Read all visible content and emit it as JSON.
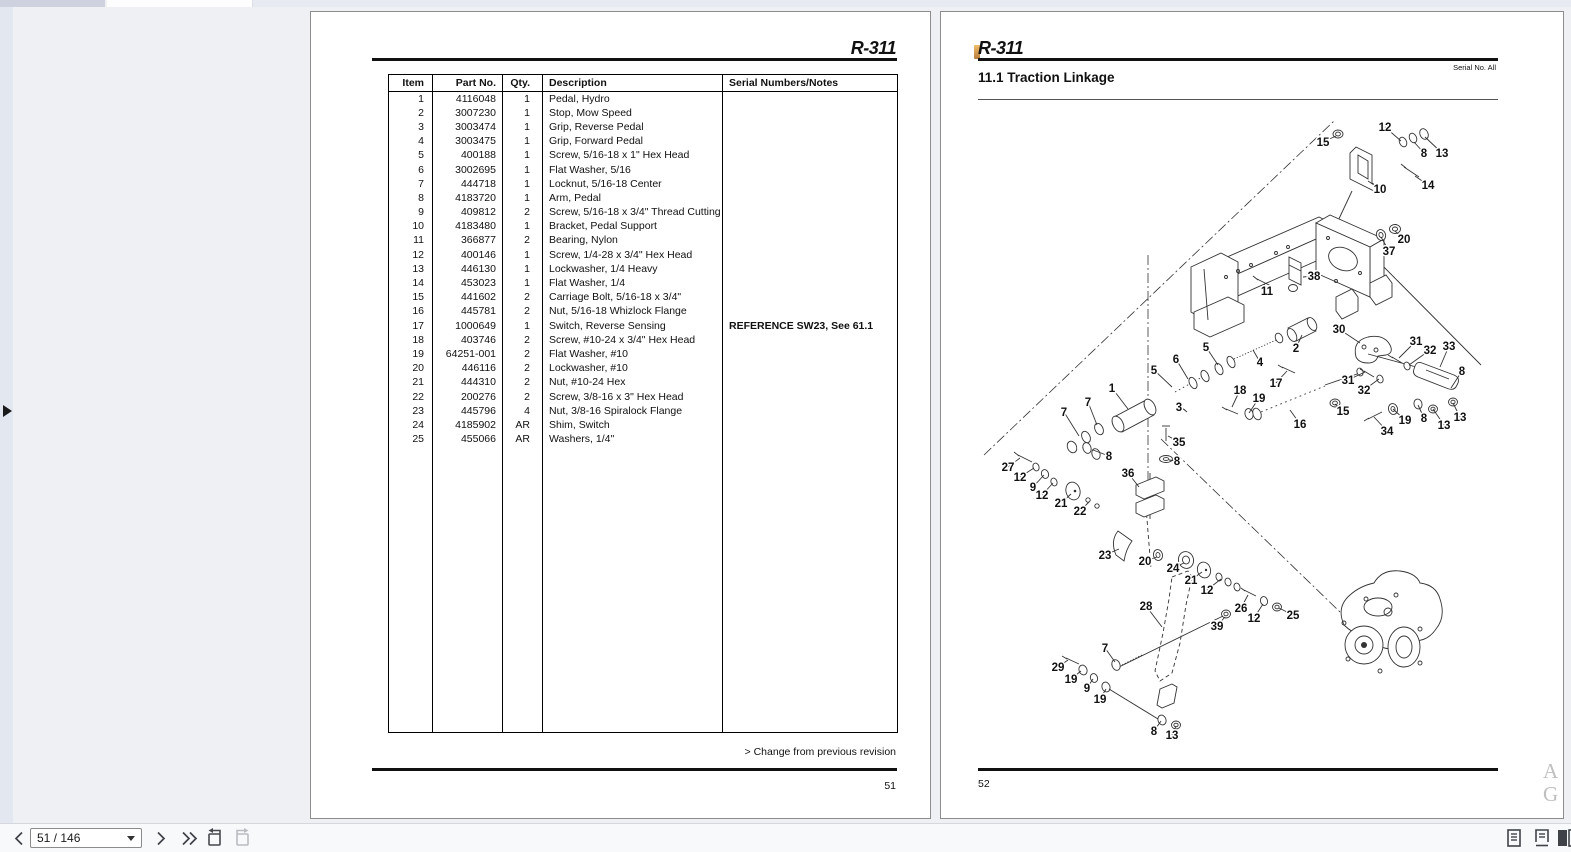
{
  "left_page": {
    "header_title": "R-311",
    "change_note": "> Change from previous revision",
    "page_number": "51",
    "table": {
      "columns": [
        "Item",
        "Part No.",
        "Qty.",
        "Description",
        "Serial Numbers/Notes"
      ],
      "rows": [
        {
          "item": "1",
          "part": "4116048",
          "qty": "1",
          "desc": "Pedal, Hydro",
          "notes": ""
        },
        {
          "item": "2",
          "part": "3007230",
          "qty": "1",
          "desc": "Stop, Mow Speed",
          "notes": ""
        },
        {
          "item": "3",
          "part": "3003474",
          "qty": "1",
          "desc": "Grip, Reverse Pedal",
          "notes": ""
        },
        {
          "item": "4",
          "part": "3003475",
          "qty": "1",
          "desc": "Grip, Forward Pedal",
          "notes": ""
        },
        {
          "item": "5",
          "part": "400188",
          "qty": "1",
          "desc": "Screw, 5/16-18 x 1\" Hex Head",
          "notes": ""
        },
        {
          "item": "6",
          "part": "3002695",
          "qty": "1",
          "desc": "Flat Washer, 5/16",
          "notes": ""
        },
        {
          "item": "7",
          "part": "444718",
          "qty": "1",
          "desc": "Locknut, 5/16-18 Center",
          "notes": ""
        },
        {
          "item": "8",
          "part": "4183720",
          "qty": "1",
          "desc": "Arm, Pedal",
          "notes": ""
        },
        {
          "item": "9",
          "part": "409812",
          "qty": "2",
          "desc": "Screw, 5/16-18 x 3/4\" Thread Cutting",
          "notes": ""
        },
        {
          "item": "10",
          "part": "4183480",
          "qty": "1",
          "desc": "Bracket, Pedal Support",
          "notes": ""
        },
        {
          "item": "11",
          "part": "366877",
          "qty": "2",
          "desc": "Bearing, Nylon",
          "notes": ""
        },
        {
          "item": "12",
          "part": "400146",
          "qty": "1",
          "desc": "Screw, 1/4-28 x 3/4\" Hex Head",
          "notes": ""
        },
        {
          "item": "13",
          "part": "446130",
          "qty": "1",
          "desc": "Lockwasher, 1/4 Heavy",
          "notes": ""
        },
        {
          "item": "14",
          "part": "453023",
          "qty": "1",
          "desc": "Flat Washer, 1/4",
          "notes": ""
        },
        {
          "item": "15",
          "part": "441602",
          "qty": "2",
          "desc": "Carriage Bolt, 5/16-18 x 3/4\"",
          "notes": ""
        },
        {
          "item": "16",
          "part": "445781",
          "qty": "2",
          "desc": "Nut, 5/16-18 Whizlock Flange",
          "notes": ""
        },
        {
          "item": "17",
          "part": "1000649",
          "qty": "1",
          "desc": "Switch, Reverse Sensing",
          "notes": "REFERENCE SW23, See 61.1"
        },
        {
          "item": "18",
          "part": "403746",
          "qty": "2",
          "desc": "Screw, #10-24 x 3/4\" Hex Head",
          "notes": ""
        },
        {
          "item": "19",
          "part": "64251-001",
          "qty": "2",
          "desc": "Flat Washer, #10",
          "notes": ""
        },
        {
          "item": "20",
          "part": "446116",
          "qty": "2",
          "desc": "Lockwasher, #10",
          "notes": ""
        },
        {
          "item": "21",
          "part": "444310",
          "qty": "2",
          "desc": "Nut, #10-24 Hex",
          "notes": ""
        },
        {
          "item": "22",
          "part": "200276",
          "qty": "2",
          "desc": "Screw, 3/8-16 x 3\" Hex Head",
          "notes": ""
        },
        {
          "item": "23",
          "part": "445796",
          "qty": "4",
          "desc": "Nut, 3/8-16 Spiralock Flange",
          "notes": ""
        },
        {
          "item": "24",
          "part": "4185902",
          "qty": "AR",
          "desc": "Shim, Switch",
          "notes": ""
        },
        {
          "item": "25",
          "part": "455066",
          "qty": "AR",
          "desc": "Washers, 1/4\"",
          "notes": ""
        }
      ]
    }
  },
  "right_page": {
    "header_title": "R-311",
    "serial_note": "Serial No. All",
    "section_title": "11.1 Traction Linkage",
    "page_number": "52",
    "watermark": "A G",
    "diagram": {
      "callouts": [
        {
          "n": "15",
          "x": 347,
          "y": 39,
          "tx": 360,
          "ty": 29
        },
        {
          "n": "12",
          "x": 409,
          "y": 24,
          "tx": 425,
          "ty": 34
        },
        {
          "n": "8",
          "x": 448,
          "y": 50,
          "tx": 438,
          "ty": 35
        },
        {
          "n": "13",
          "x": 466,
          "y": 50,
          "tx": 449,
          "ty": 30
        },
        {
          "n": "10",
          "x": 404,
          "y": 86,
          "tx": 392,
          "ty": 74
        },
        {
          "n": "14",
          "x": 452,
          "y": 82,
          "tx": 439,
          "ty": 69
        },
        {
          "n": "20",
          "x": 428,
          "y": 136,
          "tx": 419,
          "ty": 124
        },
        {
          "n": "37",
          "x": 413,
          "y": 148,
          "tx": 405,
          "ty": 130
        },
        {
          "n": "38",
          "x": 338,
          "y": 173,
          "tx": 327,
          "ty": 170
        },
        {
          "n": "11",
          "x": 291,
          "y": 188,
          "tx": 288,
          "ty": 177
        },
        {
          "n": "30",
          "x": 363,
          "y": 226,
          "tx": 384,
          "ty": 236
        },
        {
          "n": "31",
          "x": 440,
          "y": 238,
          "tx": 423,
          "ty": 251
        },
        {
          "n": "32",
          "x": 454,
          "y": 247,
          "tx": 433,
          "ty": 258
        },
        {
          "n": "33",
          "x": 473,
          "y": 243,
          "tx": 464,
          "ty": 260
        },
        {
          "n": "8",
          "x": 486,
          "y": 268,
          "tx": 475,
          "ty": 281
        },
        {
          "n": "31",
          "x": 372,
          "y": 277,
          "tx": 389,
          "ty": 265
        },
        {
          "n": "32",
          "x": 388,
          "y": 287,
          "tx": 403,
          "ty": 272
        },
        {
          "n": "2",
          "x": 320,
          "y": 245,
          "tx": 326,
          "ty": 228
        },
        {
          "n": "4",
          "x": 284,
          "y": 259,
          "tx": 277,
          "ty": 243
        },
        {
          "n": "5",
          "x": 230,
          "y": 244,
          "tx": 242,
          "ty": 258
        },
        {
          "n": "6",
          "x": 200,
          "y": 256,
          "tx": 212,
          "ty": 272
        },
        {
          "n": "5",
          "x": 178,
          "y": 267,
          "tx": 196,
          "ty": 280
        },
        {
          "n": "17",
          "x": 300,
          "y": 280,
          "tx": 311,
          "ty": 264
        },
        {
          "n": "18",
          "x": 264,
          "y": 287,
          "tx": 256,
          "ty": 300
        },
        {
          "n": "19",
          "x": 283,
          "y": 295,
          "tx": 273,
          "ty": 306
        },
        {
          "n": "1",
          "x": 136,
          "y": 285,
          "tx": 152,
          "ty": 302
        },
        {
          "n": "3",
          "x": 203,
          "y": 304,
          "tx": 209,
          "ty": 303
        },
        {
          "n": "7",
          "x": 112,
          "y": 299,
          "tx": 121,
          "ty": 318
        },
        {
          "n": "7",
          "x": 88,
          "y": 309,
          "tx": 103,
          "ty": 329
        },
        {
          "n": "15",
          "x": 367,
          "y": 308,
          "tx": 359,
          "ty": 297
        },
        {
          "n": "16",
          "x": 324,
          "y": 321,
          "tx": 314,
          "ty": 303
        },
        {
          "n": "19",
          "x": 429,
          "y": 317,
          "tx": 417,
          "ty": 302
        },
        {
          "n": "8",
          "x": 448,
          "y": 315,
          "tx": 442,
          "ty": 298
        },
        {
          "n": "13",
          "x": 468,
          "y": 322,
          "tx": 457,
          "ty": 302
        },
        {
          "n": "13",
          "x": 484,
          "y": 314,
          "tx": 477,
          "ty": 296
        },
        {
          "n": "34",
          "x": 411,
          "y": 328,
          "tx": 398,
          "ty": 310
        },
        {
          "n": "35",
          "x": 203,
          "y": 339,
          "tx": 192,
          "ty": 329
        },
        {
          "n": "8",
          "x": 201,
          "y": 358,
          "tx": 193,
          "ty": 353
        },
        {
          "n": "8",
          "x": 133,
          "y": 353,
          "tx": 117,
          "ty": 343
        },
        {
          "n": "36",
          "x": 152,
          "y": 370,
          "tx": 163,
          "ty": 380
        },
        {
          "n": "27",
          "x": 32,
          "y": 364,
          "tx": 44,
          "ty": 351
        },
        {
          "n": "12",
          "x": 44,
          "y": 374,
          "tx": 58,
          "ty": 361
        },
        {
          "n": "9",
          "x": 57,
          "y": 384,
          "tx": 68,
          "ty": 368
        },
        {
          "n": "12",
          "x": 66,
          "y": 392,
          "tx": 77,
          "ty": 376
        },
        {
          "n": "21",
          "x": 85,
          "y": 400,
          "tx": 95,
          "ty": 387
        },
        {
          "n": "22",
          "x": 104,
          "y": 408,
          "tx": 113,
          "ty": 395
        },
        {
          "n": "23",
          "x": 129,
          "y": 452,
          "tx": 143,
          "ty": 442
        },
        {
          "n": "20",
          "x": 169,
          "y": 458,
          "tx": 181,
          "ty": 450
        },
        {
          "n": "24",
          "x": 197,
          "y": 465,
          "tx": 208,
          "ty": 456
        },
        {
          "n": "21",
          "x": 215,
          "y": 477,
          "tx": 226,
          "ty": 465
        },
        {
          "n": "12",
          "x": 231,
          "y": 487,
          "tx": 245,
          "ty": 472
        },
        {
          "n": "26",
          "x": 265,
          "y": 505,
          "tx": 272,
          "ty": 488
        },
        {
          "n": "12",
          "x": 278,
          "y": 515,
          "tx": 287,
          "ty": 497
        },
        {
          "n": "25",
          "x": 317,
          "y": 512,
          "tx": 303,
          "ty": 501
        },
        {
          "n": "39",
          "x": 241,
          "y": 523,
          "tx": 249,
          "ty": 510
        },
        {
          "n": "28",
          "x": 170,
          "y": 503,
          "tx": 186,
          "ty": 520
        },
        {
          "n": "7",
          "x": 129,
          "y": 545,
          "tx": 139,
          "ty": 555
        },
        {
          "n": "29",
          "x": 82,
          "y": 564,
          "tx": 92,
          "ty": 553
        },
        {
          "n": "19",
          "x": 95,
          "y": 576,
          "tx": 105,
          "ty": 564
        },
        {
          "n": "9",
          "x": 111,
          "y": 585,
          "tx": 117,
          "ty": 572
        },
        {
          "n": "19",
          "x": 124,
          "y": 596,
          "tx": 130,
          "ty": 582
        },
        {
          "n": "8",
          "x": 178,
          "y": 628,
          "tx": 185,
          "ty": 614
        },
        {
          "n": "13",
          "x": 196,
          "y": 632,
          "tx": 200,
          "ty": 619
        }
      ]
    }
  },
  "toolbar": {
    "page_indicator": "51 / 146",
    "icons": [
      "previous-page",
      "next-page",
      "last-page",
      "rotate-counterclockwise",
      "rotate-clockwise",
      "single-page-view",
      "continuous-scroll-view",
      "two-page-view"
    ]
  },
  "sidebar": {
    "toggle": "expand"
  }
}
